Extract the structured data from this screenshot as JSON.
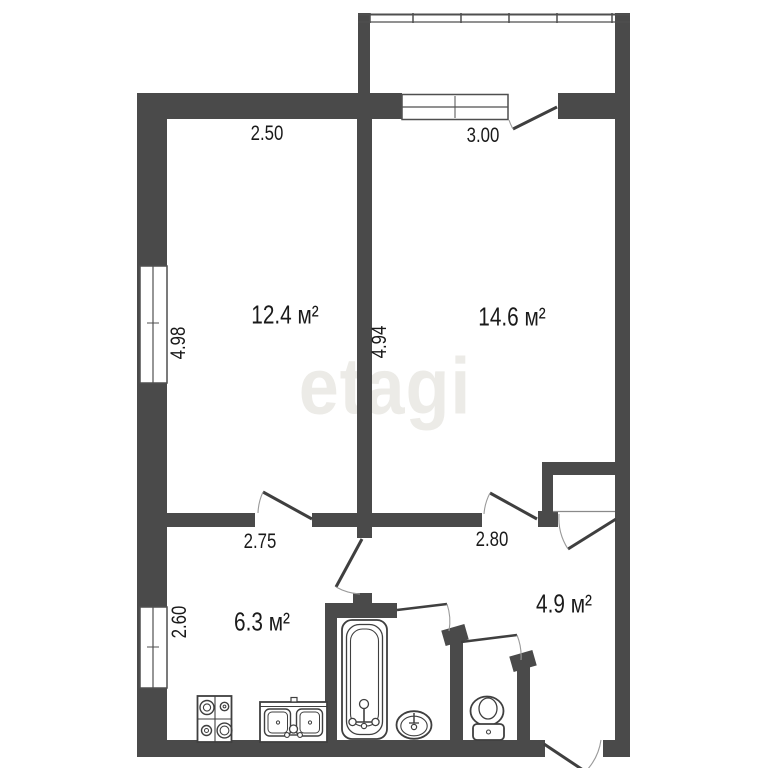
{
  "watermark": "etagi",
  "rooms": [
    {
      "name": "living-room-small",
      "area": "12.4 м²"
    },
    {
      "name": "living-room-large",
      "area": "14.6 м²"
    },
    {
      "name": "kitchen",
      "area": "6.3 м²"
    },
    {
      "name": "hallway",
      "area": "4.9 м²"
    }
  ],
  "dimensions": [
    {
      "name": "top-left-width",
      "value": "2.50"
    },
    {
      "name": "top-right-width",
      "value": "3.00"
    },
    {
      "name": "left-upper-height",
      "value": "4.98"
    },
    {
      "name": "center-height",
      "value": "4.94"
    },
    {
      "name": "left-lower-height",
      "value": "2.60"
    },
    {
      "name": "mid-left-width",
      "value": "2.75"
    },
    {
      "name": "mid-right-width",
      "value": "2.80"
    }
  ],
  "fixtures": [
    "bathtub",
    "wash-basin",
    "toilet",
    "stove",
    "kitchen-sink",
    "balcony-glazing",
    "closet"
  ],
  "colors": {
    "wall": "#4a4a4a",
    "line": "#3f3f3f",
    "arc": "#8a8a8a",
    "text": "#1a1a1a",
    "watermark": "#ecebe7",
    "background": "#ffffff"
  }
}
